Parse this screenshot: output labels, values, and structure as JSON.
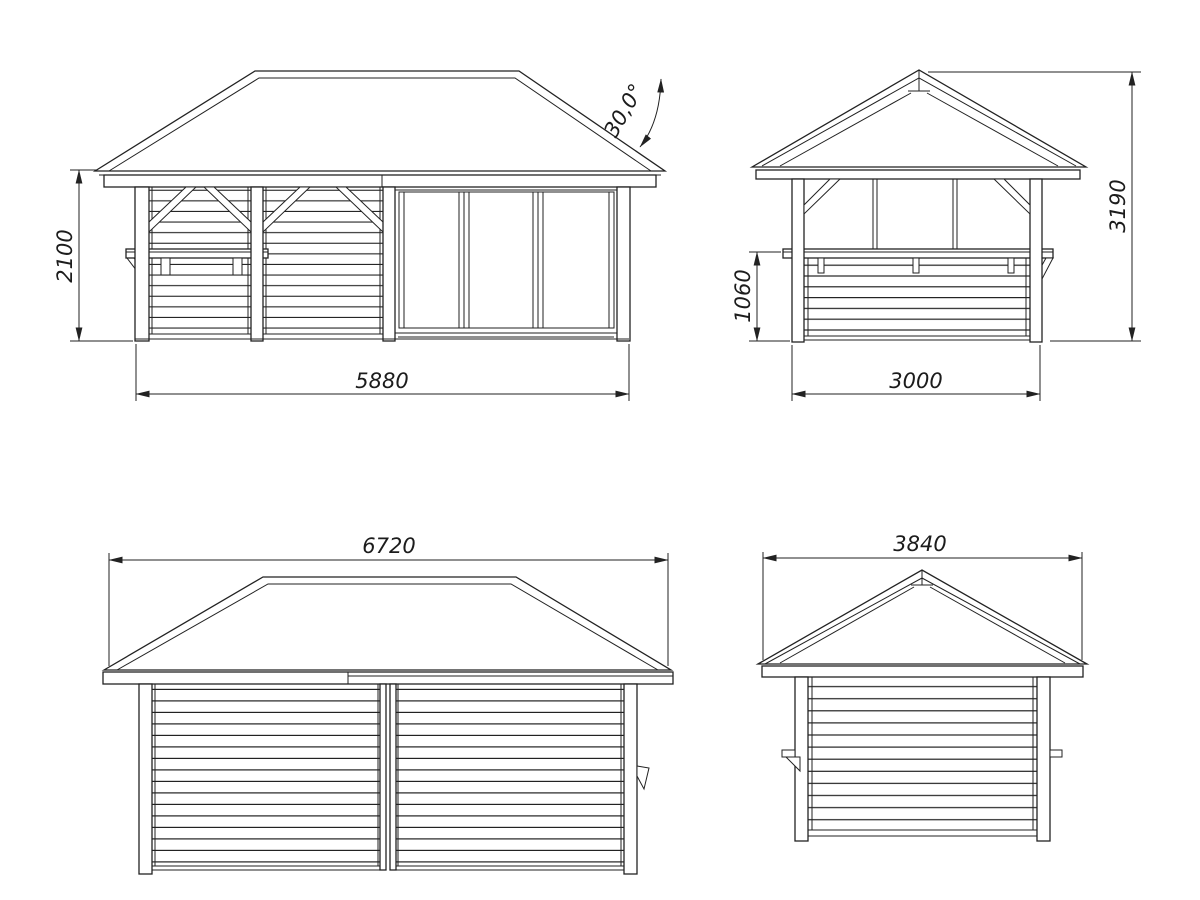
{
  "palette": {
    "background": "#ffffff",
    "line": "#222222"
  },
  "views": {
    "front_elevation": {
      "wall_height": "2100",
      "overall_width": "5880",
      "roof_angle": "30,0°"
    },
    "side_elevation": {
      "parapet_height": "1060",
      "total_height": "3190",
      "overall_width": "3000"
    },
    "rear_elevation": {
      "roof_width": "6720"
    },
    "opposite_side_elevation": {
      "roof_width": "3840"
    }
  }
}
